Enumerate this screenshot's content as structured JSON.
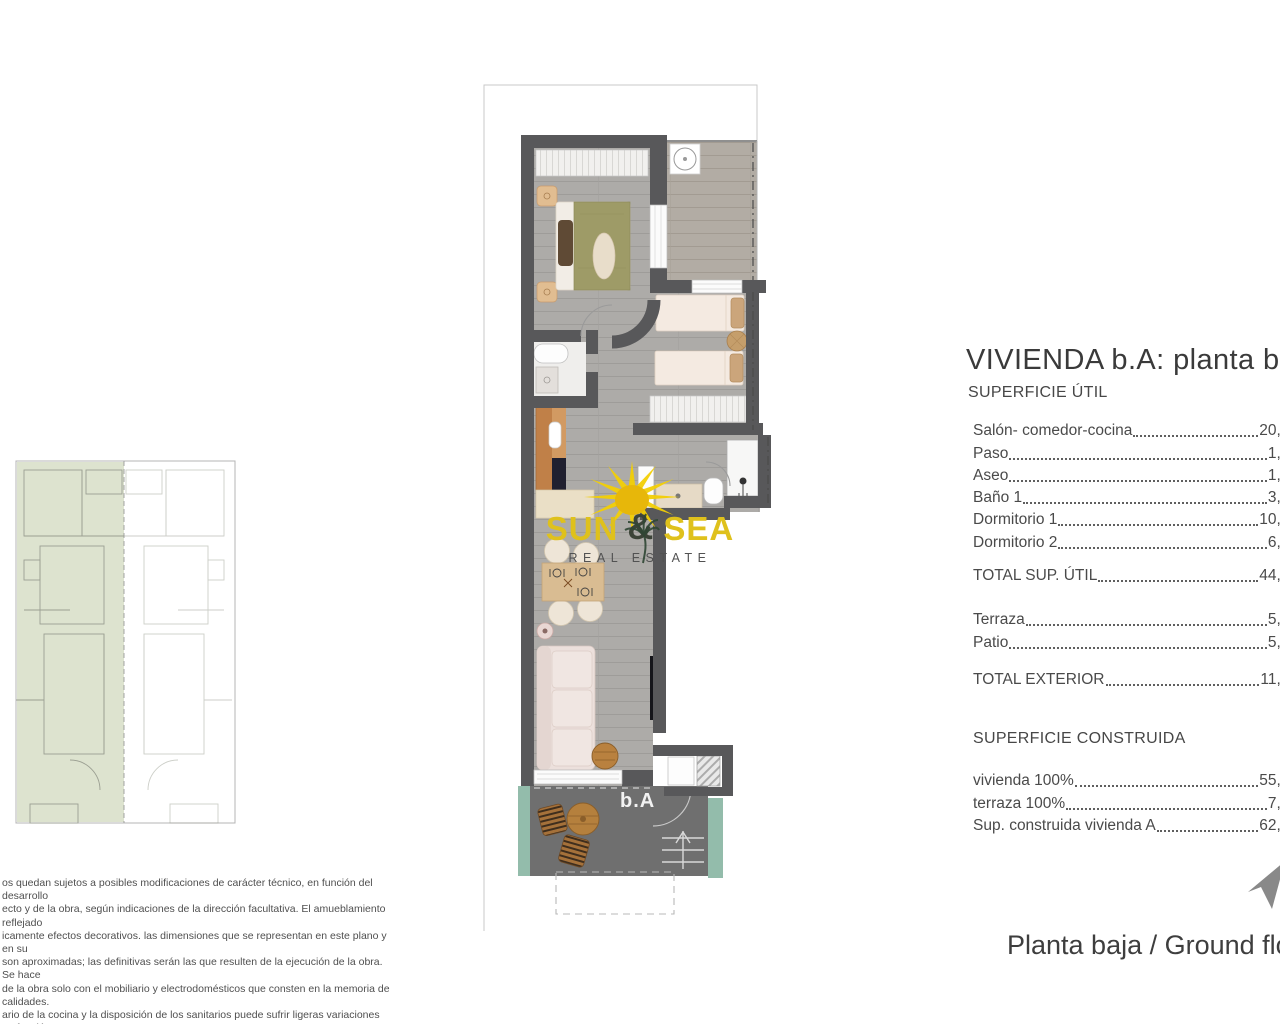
{
  "page": {
    "width": 1280,
    "height": 1024,
    "background": "#ffffff"
  },
  "title_block": {
    "title": "VIVIENDA b.A: planta baja",
    "section_useful": "SUPERFICIE ÚTIL",
    "useful": [
      {
        "label": "Salón- comedor-cocina",
        "value": "20,81"
      },
      {
        "label": "Paso",
        "value": "1,35"
      },
      {
        "label": "Aseo",
        "value": "1,68"
      },
      {
        "label": "Baño 1",
        "value": "3,61"
      },
      {
        "label": "Dormitorio 1",
        "value": "10,01"
      },
      {
        "label": "Dormitorio 2",
        "value": "6,83"
      }
    ],
    "total_useful": {
      "label": "TOTAL SUP. ÚTIL",
      "value": "44,29"
    },
    "exterior": [
      {
        "label": "Terraza",
        "value": "5,72"
      },
      {
        "label": "Patio",
        "value": "5,55"
      }
    ],
    "total_exterior": {
      "label": "TOTAL EXTERIOR",
      "value": "11,27"
    },
    "section_built": "SUPERFICIE CONSTRUIDA",
    "built": [
      {
        "label": "vivienda 100%",
        "value": "55,31"
      },
      {
        "label": "terraza 100%",
        "value": "7,54"
      },
      {
        "label": "Sup. construida vivienda A",
        "value": "62,85"
      }
    ]
  },
  "floor_plan": {
    "unit_label": "b.A"
  },
  "logo": {
    "word1": "SUN",
    "amp": "&",
    "word2": "SEA",
    "tagline": "REAL ESTATE"
  },
  "footer": {
    "caption": "Planta baja / Ground floor"
  },
  "disclaimer": {
    "lines": [
      "os quedan sujetos a posibles modificaciones de carácter técnico, en función del desarrollo",
      "ecto y de la obra, según indicaciones de la dirección facultativa. El amueblamiento reflejado",
      "icamente efectos decorativos. las dimensiones que se representan en este plano y en su",
      "son aproximadas; las definitivas serán las que resulten de la ejecución de la obra. Se hace",
      "de la obra solo con el mobiliario y electrodomésticos que consten en la memoria de calidades.",
      "ario de la cocina y la disposición de los sanitarios puede sufrir ligeras variaciones en función",
      "taje definitivo."
    ]
  },
  "colors": {
    "wall": "#58585a",
    "floor": "#adaba8",
    "terrace_floor": "#6f6f6f",
    "accent_teal": "#93bcab",
    "keyplan_highlight": "#dde3cf",
    "logo_yellow": "#dfc11c",
    "sun_yellow": "#f2cf05"
  }
}
